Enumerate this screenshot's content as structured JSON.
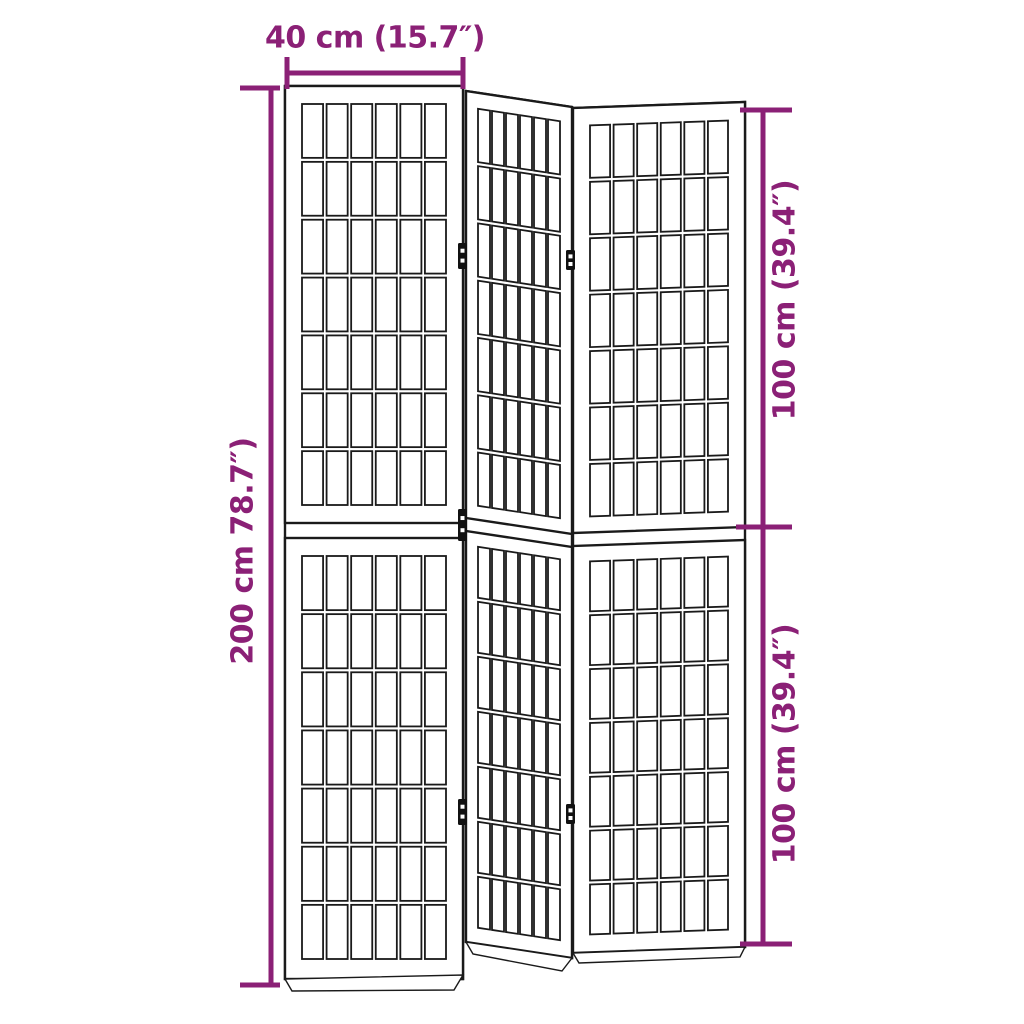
{
  "diagram": {
    "subject": "3-panel folding room divider with shoji-style lattice panels",
    "labels": {
      "width": "40 cm (15.7″)",
      "total_height": "200 cm 78.7″)",
      "upper_height": "100 cm (39.4″)",
      "lower_height": "100 cm (39.4″)"
    },
    "colors": {
      "dimension": "#8b2076",
      "outline": "#1a1a1a",
      "hinge": "#111111",
      "background": "#ffffff"
    },
    "structure": {
      "panel_count": 3,
      "halves_per_panel": 2,
      "lattice_columns": 6,
      "lattice_rows_per_half": 7,
      "visible_hinges": 5
    }
  }
}
